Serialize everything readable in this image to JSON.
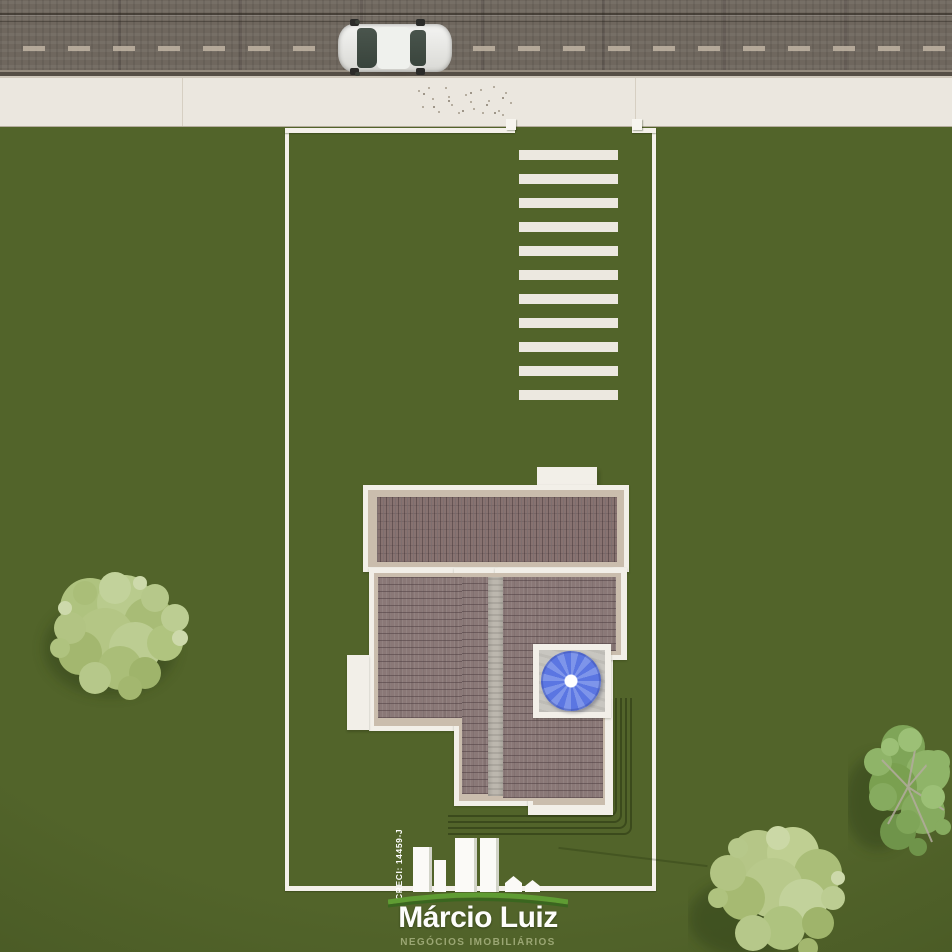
{
  "brand": {
    "creci": "CRECI: 14459-J",
    "name": "Márcio Luiz",
    "tagline": "NEGÓCIOS IMOBILIÁRIOS"
  },
  "palette": {
    "grass": "#52642a",
    "asphalt": "#6f675e",
    "sidewalk": "#ebe7df",
    "lot_line_white": "#f4f1ea",
    "roof_tile": "#8a7877",
    "roof_top_band": "#877270",
    "walkway_gray": "#bcb7ae",
    "patio_gray": "#c8c6c0",
    "umbrella_blue": "#5b76e2",
    "logo_swoosh_green": "#5f9c33",
    "tagline_green": "#9aa673",
    "tree_light_green": "#b4c685",
    "tree_dark_green": "#83a85c",
    "car_body": "#eff1ed"
  }
}
